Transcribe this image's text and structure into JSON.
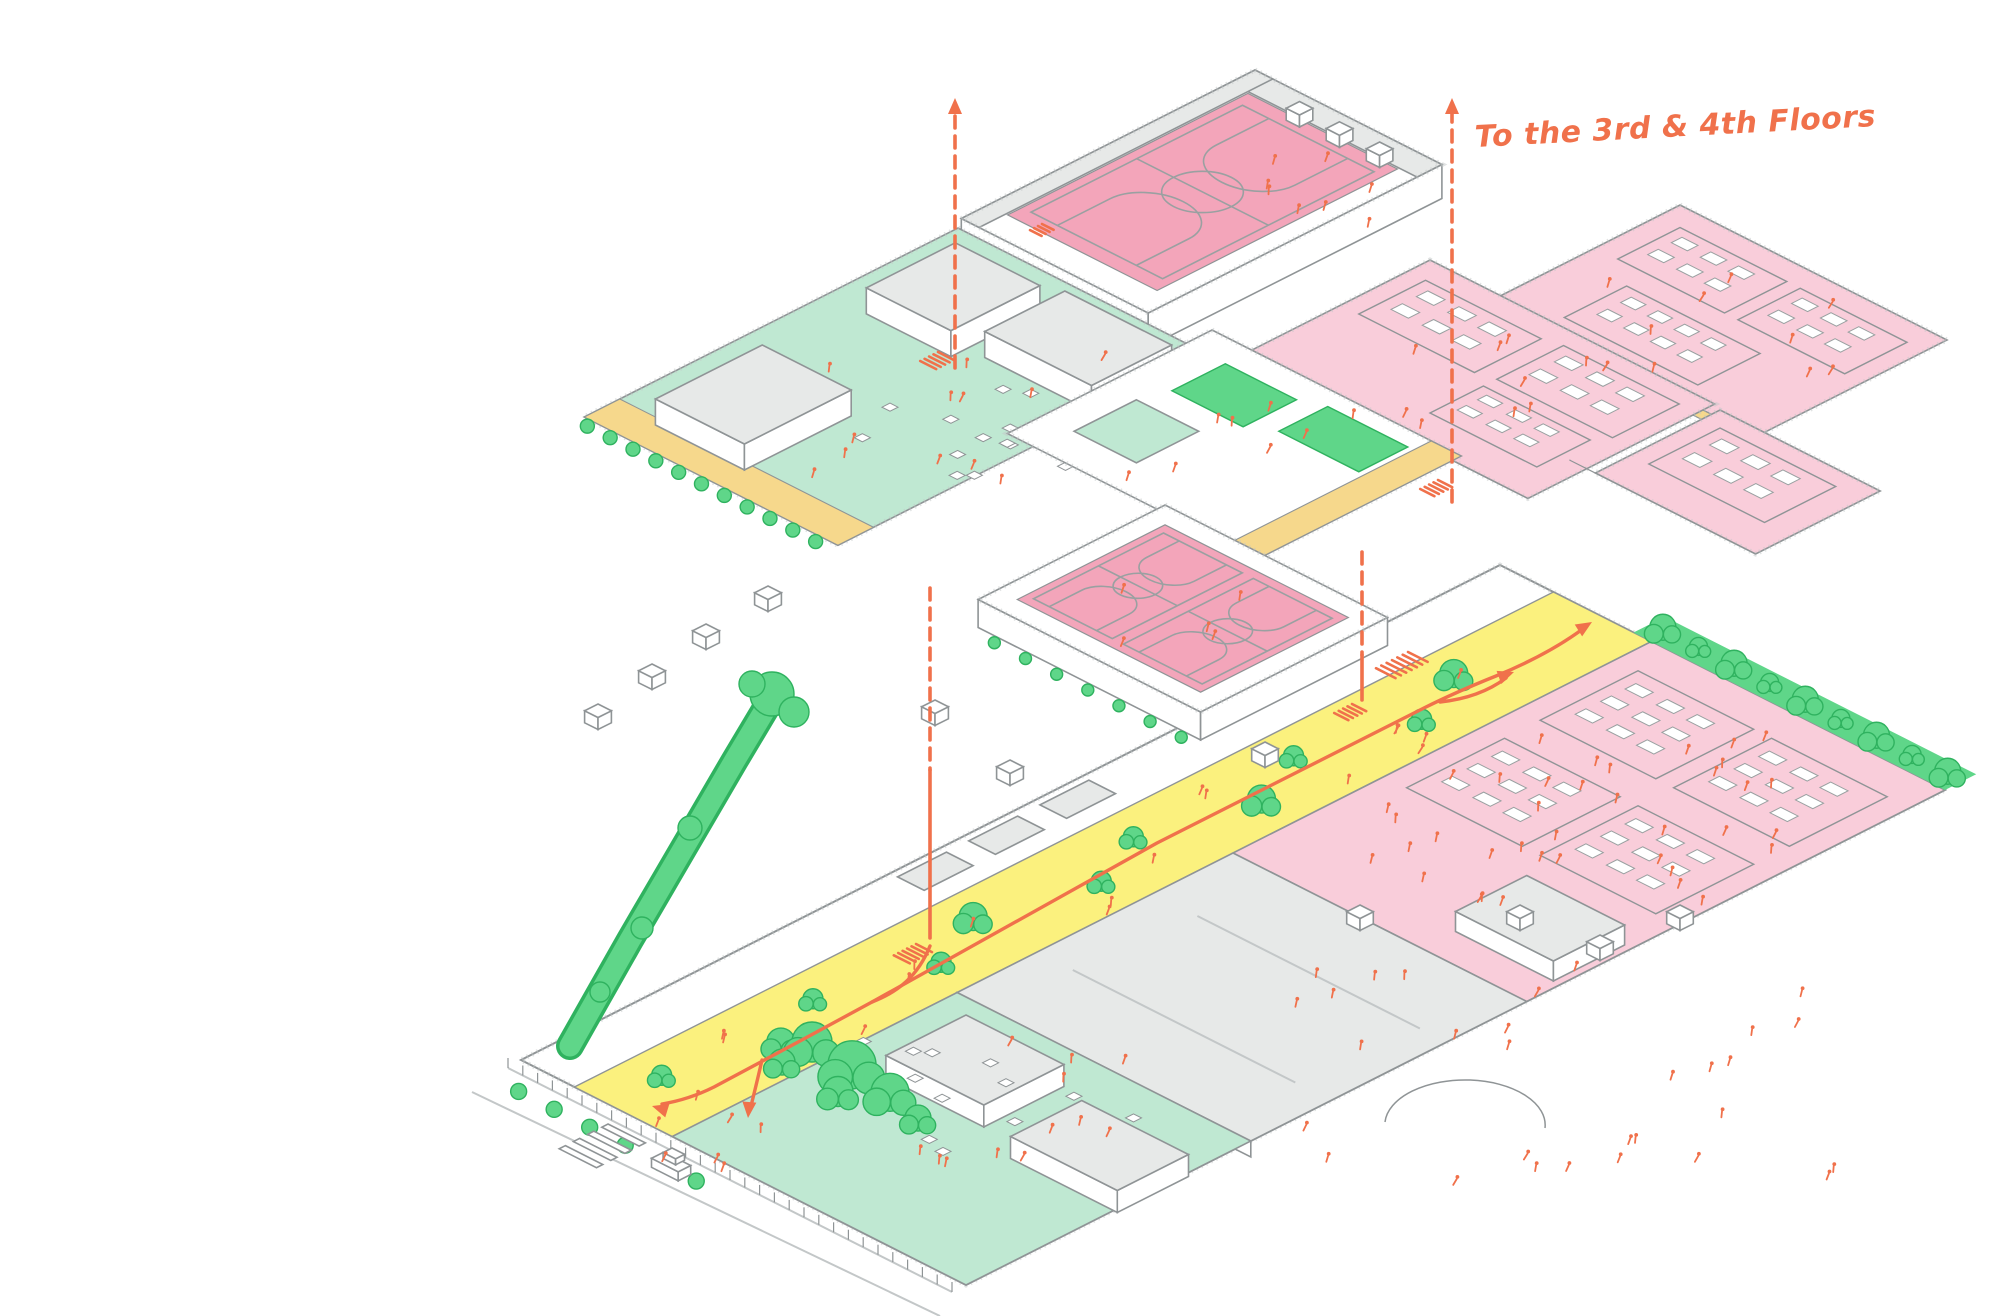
{
  "annotation": {
    "to_floors": "To the 3rd & 4th Floors"
  },
  "palette": {
    "background": "#ffffff",
    "outline": "#8f9496",
    "outline_light": "#c3c7c8",
    "roof_gray": "#e7e9e8",
    "mint": "#bfe8d2",
    "pink_light": "#f9d2de",
    "pink_zone": "#f9cdda",
    "pink_court": "#f3a5ba",
    "yellow_band": "#f6d88c",
    "street_yellow": "#fbf17e",
    "green": "#5fd689",
    "green_dark": "#2fb25f",
    "orange": "#f0714b",
    "court_line": "#9aa0a1"
  }
}
